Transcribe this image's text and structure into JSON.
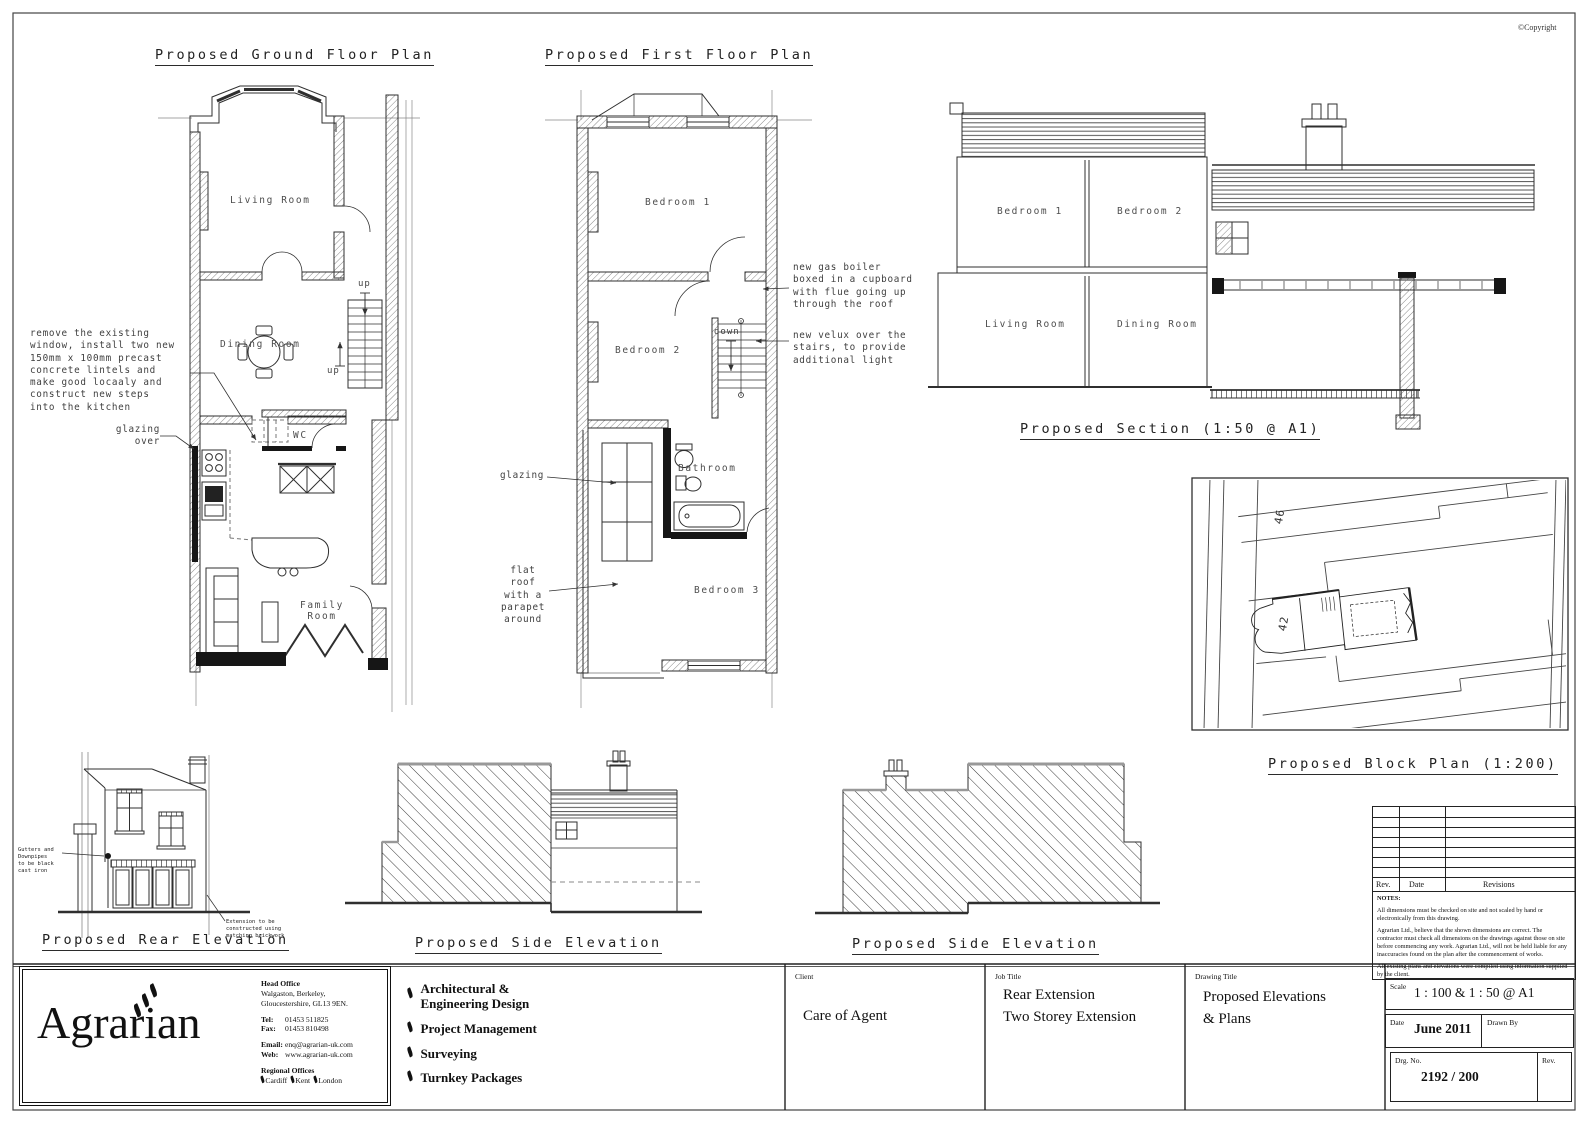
{
  "sheet": {
    "copyright": "©Copyright"
  },
  "plans": {
    "ground": {
      "title": "Proposed Ground Floor Plan",
      "living": "Living Room",
      "dining": "Dining Room",
      "wc": "WC",
      "family": "Family\nRoom",
      "up": "up",
      "note_lintels": "remove the existing\nwindow, install two new\n150mm x 100mm precast\nconcrete lintels and\nmake good locaaly and\nconstruct new steps\ninto the kitchen",
      "note_glazing": "glazing\nover"
    },
    "first": {
      "title": "Proposed First Floor Plan",
      "bedroom1": "Bedroom 1",
      "bedroom2": "Bedroom 2",
      "bedroom3": "Bedroom 3",
      "bathroom": "Bathroom",
      "down": "down",
      "note_boiler": "new gas boiler\nboxed in a cupboard\nwith flue going up\nthrough the roof",
      "note_velux": "new velux over the\nstairs, to provide\nadditional light",
      "note_glazing": "glazing",
      "note_flatroof": "flat roof\nwith a\nparapet\naround"
    },
    "section": {
      "title": "Proposed Section (1:50 @ A1)",
      "bedroom1": "Bedroom 1",
      "bedroom2": "Bedroom 2",
      "living": "Living Room",
      "dining": "Dining Room"
    },
    "block": {
      "title": "Proposed Block Plan (1:200)",
      "plot_a": "46",
      "plot_b": "42"
    },
    "rear_elevation": {
      "title": "Proposed Rear Elevation",
      "note_gutters": "Gutters and Downpipes\nto be black cast iron",
      "note_brickwork": "Extension to be\nconstructed using\nmatching brickwork"
    },
    "side_elevation_left": {
      "title": "Proposed Side Elevation"
    },
    "side_elevation_right": {
      "title": "Proposed Side Elevation"
    }
  },
  "revisions": {
    "rev": "Rev.",
    "date": "Date",
    "revisions": "Revisions"
  },
  "notes": {
    "heading": "NOTES:",
    "p1": "All dimensions must be checked on site and not scaled by hand or electronically from this drawing.",
    "p2": "Agrarian Ltd., believe that the shown dimensions are correct. The contractor must check all dimensions on the drawings against those on site before commencing any work. Agrarian Ltd., will not be held liable for any inaccuracies found on the plan after the commencement of works.",
    "p3": "All existing plans and elevations were compiled using information supplied by the client."
  },
  "titleblock": {
    "logo": "Agrarian",
    "head_office_label": "Head Office",
    "address": "Walgaston, Berkeley,\nGloucestershire, GL13 9EN.",
    "tel_label": "Tel:",
    "tel": "01453 511825",
    "fax_label": "Fax:",
    "fax": "01453 810498",
    "email_label": "Email:",
    "email": "enq@agrarian-uk.com",
    "web_label": "Web:",
    "web": "www.agrarian-uk.com",
    "regional_label": "Regional Offices",
    "regions": [
      "Cardiff",
      "Kent",
      "London"
    ],
    "services": [
      "Architectural &\nEngineering Design",
      "Project Management",
      "Surveying",
      "Turnkey Packages"
    ],
    "client_label": "Client",
    "client": "Care of Agent",
    "job_label": "Job Title",
    "job": "Rear Extension\nTwo Storey Extension",
    "drawing_label": "Drawing Title",
    "drawing": "Proposed Elevations\n& Plans",
    "scale_label": "Scale",
    "scale": "1 : 100 & 1 : 50 @ A1",
    "date_label": "Date",
    "date": "June 2011",
    "drawnby_label": "Drawn By",
    "drgno_label": "Drg. No.",
    "drgno": "2192 / 200",
    "rev_label": "Rev."
  }
}
